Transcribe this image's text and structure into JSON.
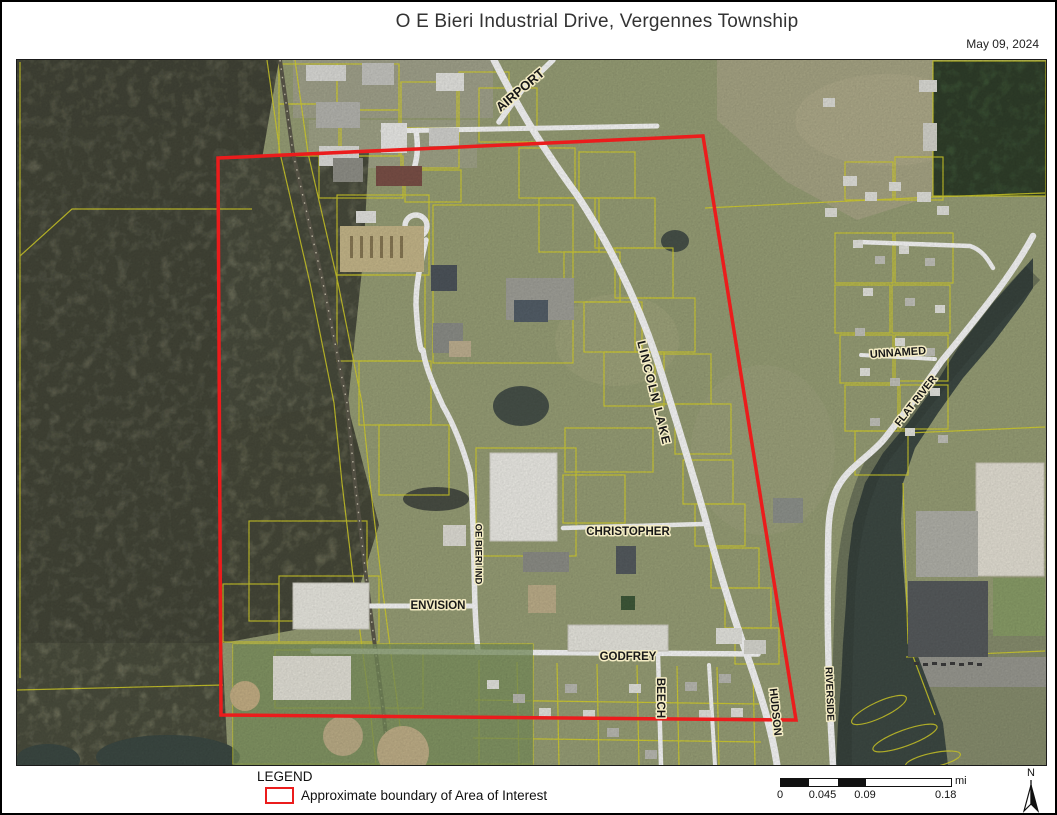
{
  "page": {
    "title": "O E Bieri Industrial Drive, Vergennes Township",
    "date": "May 09, 2024"
  },
  "map": {
    "road_labels": [
      {
        "id": "airport",
        "text": "AIRPORT"
      },
      {
        "id": "lincoln-lake",
        "text": "LINCOLN LAKE"
      },
      {
        "id": "unnamed",
        "text": "UNNAMED"
      },
      {
        "id": "flat-river",
        "text": "FLAT RIVER"
      },
      {
        "id": "christopher",
        "text": "CHRISTOPHER"
      },
      {
        "id": "oe-bieri-ind",
        "text": "OE BIERI IND"
      },
      {
        "id": "envision",
        "text": "ENVISION"
      },
      {
        "id": "godfrey",
        "text": "GODFREY"
      },
      {
        "id": "beech",
        "text": "BEECH"
      },
      {
        "id": "hudson",
        "text": "HUDSON"
      },
      {
        "id": "riverside",
        "text": "RIVERSIDE"
      }
    ],
    "colors": {
      "boundary": "#eb1c1c",
      "parcel_lines": "#ddd829",
      "water": "#3e4a44"
    }
  },
  "legend": {
    "title": "LEGEND",
    "items": [
      {
        "label": "Approximate boundary of Area of Interest",
        "swatch_color": "#eb1c1c"
      }
    ]
  },
  "scale_bar": {
    "ticks": [
      "0",
      "0.045",
      "0.09",
      "0.18"
    ],
    "unit": "mi"
  },
  "compass": {
    "label": "N"
  }
}
